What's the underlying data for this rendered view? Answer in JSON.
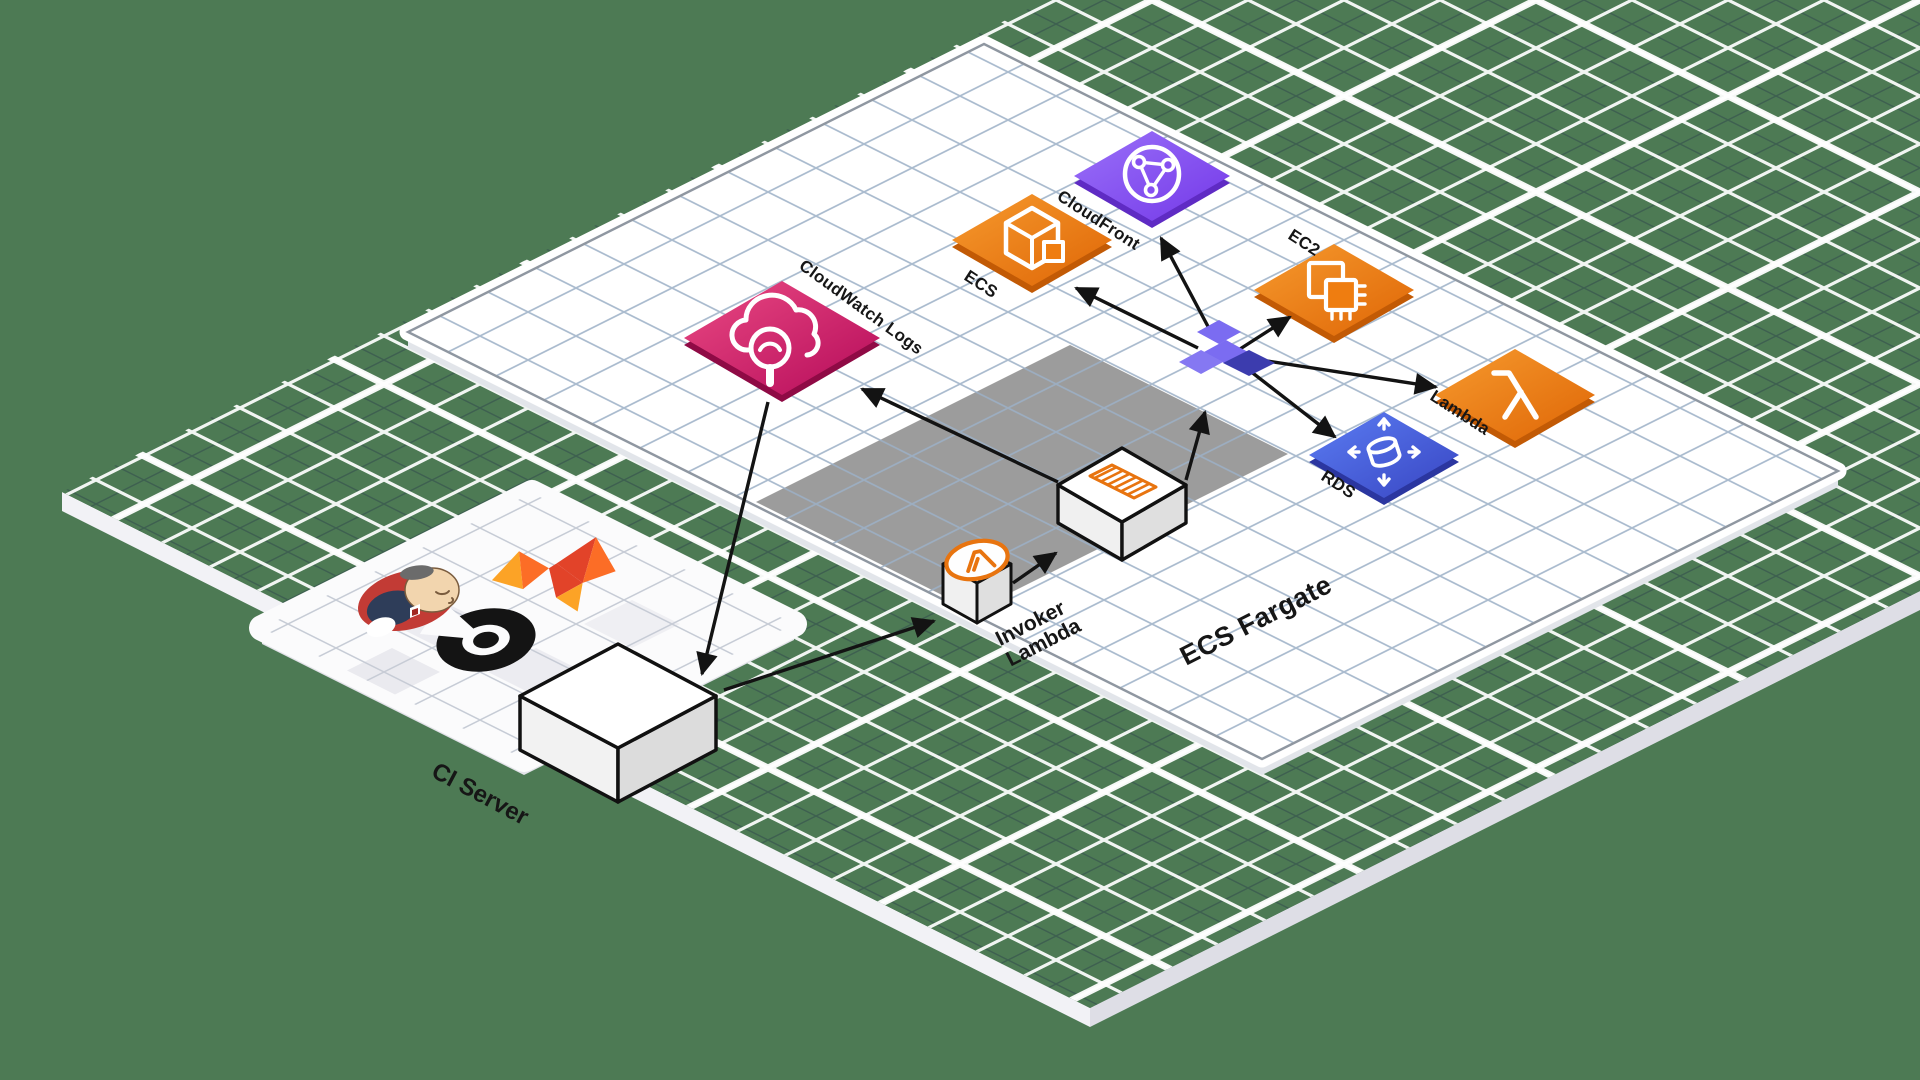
{
  "diagram": {
    "labels": {
      "cloudwatch": "CloudWatch Logs",
      "ecs": "ECS",
      "cloudfront": "CloudFront",
      "ec2": "EC2",
      "lambda": "Lambda",
      "rds": "RDS",
      "fargate_zone": "ECS Fargate",
      "invoker_line1": "Invoker",
      "invoker_line2": "Lambda",
      "ci_server": "CI Server"
    },
    "icons": {
      "ci_tools": [
        "jenkins-icon",
        "gitlab-icon",
        "circleci-icon"
      ],
      "aws": [
        "cloudwatch-logs-icon",
        "ecs-icon",
        "cloudfront-icon",
        "ec2-icon",
        "lambda-icon",
        "rds-icon",
        "invoker-lambda-cube-icon",
        "fargate-task-container-icon",
        "network-hub-icon"
      ]
    },
    "colors": {
      "background": "#4d7a54",
      "cloudwatch_pink": "#d6246d",
      "compute_orange": "#ed7711",
      "cloudfront_purple": "#8650f0",
      "rds_blue": "#4b5fe2",
      "fargate_zone_gray": "#9c9c9c",
      "hub_purple": "#7b6cf1",
      "hub_dark": "#3c3cae",
      "arrow_black": "#131313"
    }
  }
}
